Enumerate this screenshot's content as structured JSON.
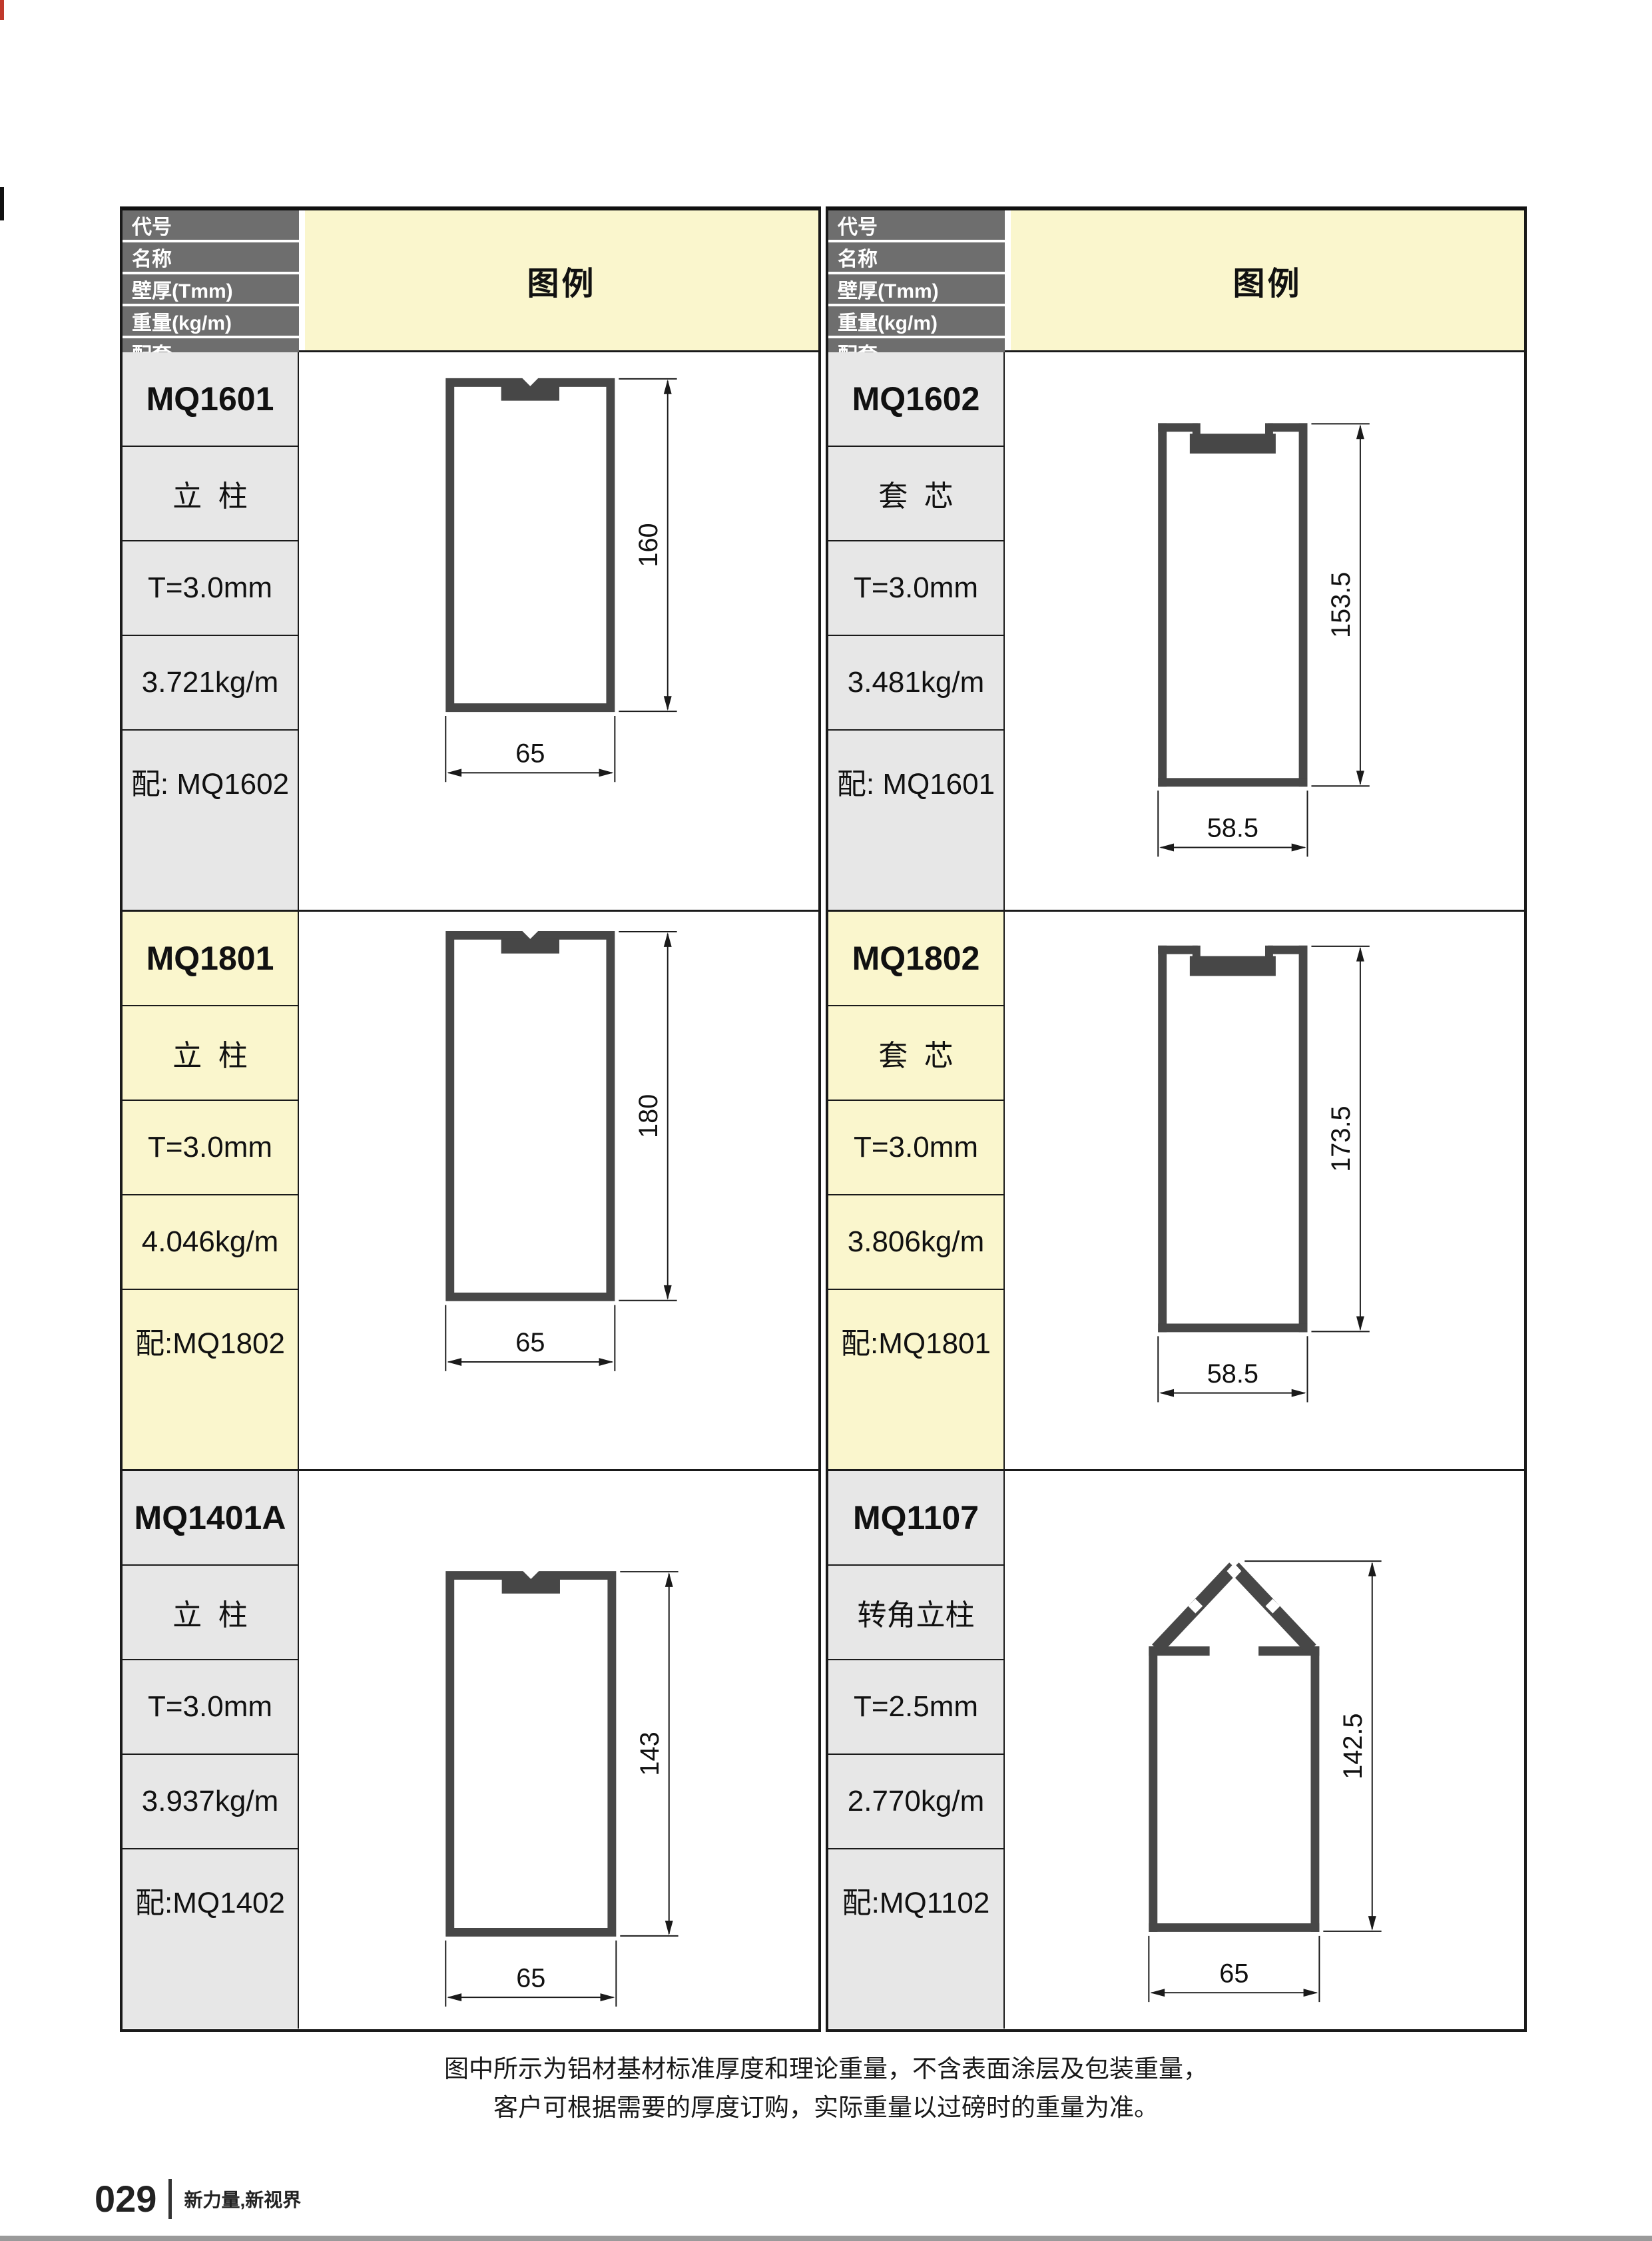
{
  "header": {
    "row_labels": [
      "代号",
      "名称",
      "壁厚(Tmm)",
      "重量(kg/m)",
      "配套"
    ],
    "legend_label": "图例"
  },
  "profiles": [
    {
      "code": "MQ1601",
      "name": "立  柱",
      "thickness": "T=3.0mm",
      "weight": "3.721kg/m",
      "match": "配: MQ1602",
      "height_dim": "160",
      "width_dim": "65"
    },
    {
      "code": "MQ1602",
      "name": "套  芯",
      "thickness": "T=3.0mm",
      "weight": "3.481kg/m",
      "match": "配: MQ1601",
      "height_dim": "153.5",
      "width_dim": "58.5"
    },
    {
      "code": "MQ1801",
      "name": "立  柱",
      "thickness": "T=3.0mm",
      "weight": "4.046kg/m",
      "match": "配:MQ1802",
      "height_dim": "180",
      "width_dim": "65"
    },
    {
      "code": "MQ1802",
      "name": "套  芯",
      "thickness": "T=3.0mm",
      "weight": "3.806kg/m",
      "match": "配:MQ1801",
      "height_dim": "173.5",
      "width_dim": "58.5"
    },
    {
      "code": "MQ1401A",
      "name": "立  柱",
      "thickness": "T=3.0mm",
      "weight": "3.937kg/m",
      "match": "配:MQ1402",
      "height_dim": "143",
      "width_dim": "65"
    },
    {
      "code": "MQ1107",
      "name": "转角立柱",
      "thickness": "T=2.5mm",
      "weight": "2.770kg/m",
      "match": "配:MQ1102",
      "height_dim": "142.5",
      "width_dim": "65"
    }
  ],
  "footer": {
    "note_line1": "图中所示为铝材基材标准厚度和理论重量，不含表面涂层及包装重量，",
    "note_line2": "客户可根据需要的厚度订购，实际重量以过磅时的重量为准。",
    "page_number": "029",
    "brand_slogan": "新力量,新视界"
  },
  "colors": {
    "legend_bg": "#faf6cd",
    "header_cell_bg": "#6e6e6e",
    "label_bg": "#e7e7e7",
    "highlight_row_bg": "#faf6cd",
    "profile_fill": "#474747",
    "line": "#1a1a1a",
    "bottom_bar": "#9a9a9a"
  }
}
